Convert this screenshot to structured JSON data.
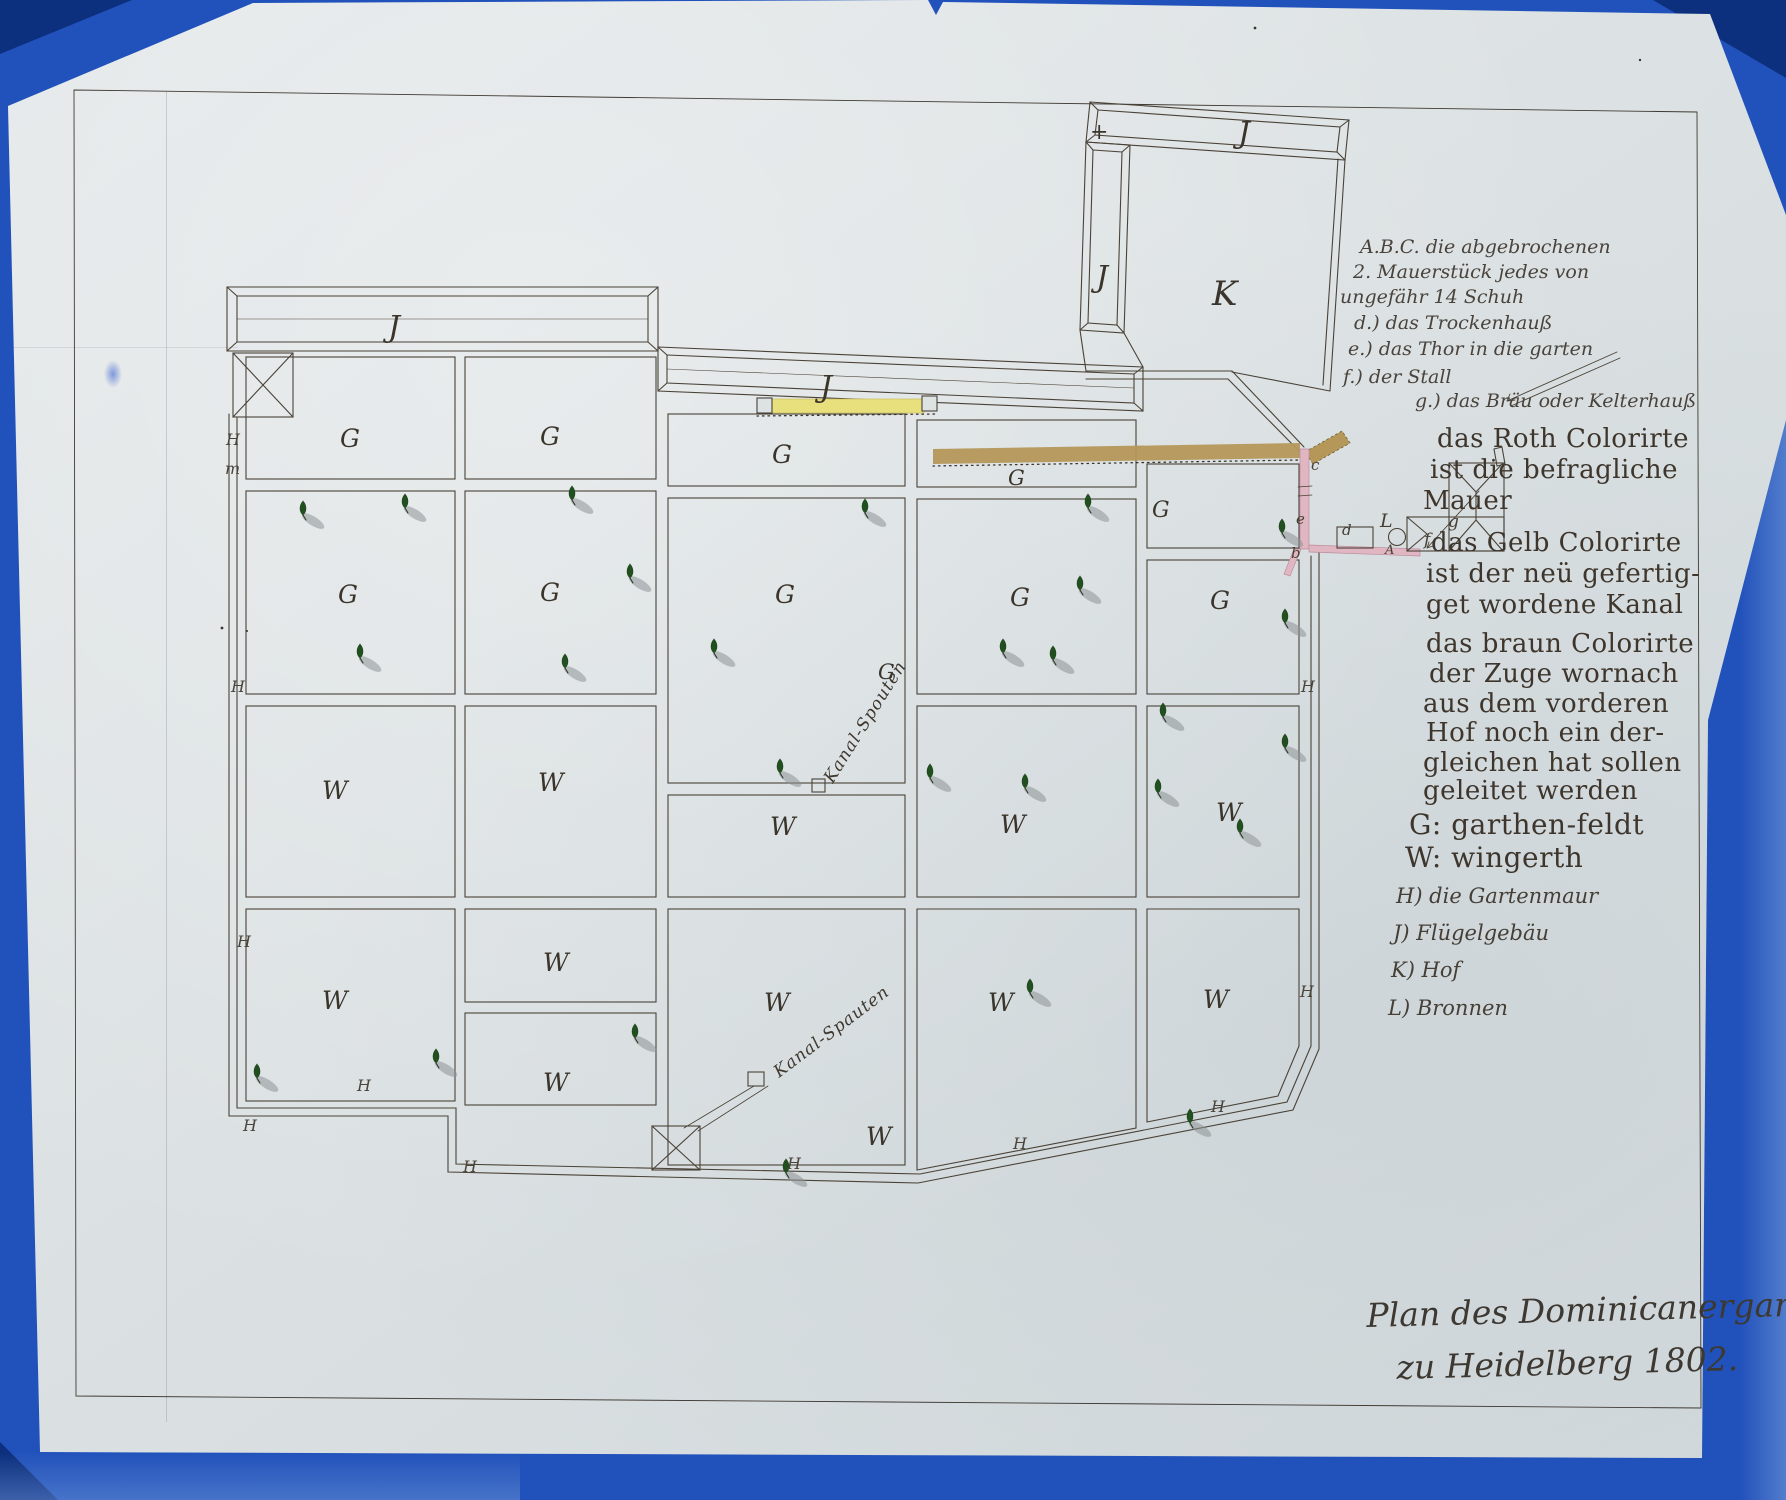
{
  "document": {
    "kind": "hand-drawn garden plan, Heidelberg 1802",
    "title_lines": [
      {
        "t": "Plan des Dominicanergartens",
        "x": 1366,
        "y": 1296,
        "r": -1.5
      },
      {
        "t": "zu Heidelberg 1802.",
        "x": 1396,
        "y": 1348,
        "r": -1.5
      }
    ]
  },
  "colors": {
    "scanner_blue": "#2152bb",
    "scanner_blue_dark": "#0c2f7e",
    "scanner_blue_light": "#6d94d6",
    "paper": "#dde2e3",
    "ink": "#4a4237",
    "ink_dark": "#332d26",
    "canal_yellow": "#e8df7d",
    "canal_brown": "#b5975a",
    "wall_pink": "#e0b6c2",
    "tree_green": "#21501f",
    "shadow_grey": "#8e9496"
  },
  "legend": {
    "script_notes": [
      {
        "t": "A.B.C. die abgebrochenen",
        "x": 1360,
        "y": 236
      },
      {
        "t": "2. Mauerstück jedes von",
        "x": 1353,
        "y": 261
      },
      {
        "t": "ungefähr 14 Schuh",
        "x": 1340,
        "y": 286
      },
      {
        "t": "d.) das Trockenhauß",
        "x": 1354,
        "y": 312
      },
      {
        "t": "e.) das Thor in die garten",
        "x": 1348,
        "y": 338
      },
      {
        "t": "f.) der Stall",
        "x": 1343,
        "y": 366
      },
      {
        "t": "g.) das Bräu oder Kelterhauß",
        "x": 1415,
        "y": 390
      }
    ],
    "gothic_lines": [
      {
        "t": "das Roth Colorirte",
        "x": 1437,
        "y": 424
      },
      {
        "t": "ist die befragliche",
        "x": 1430,
        "y": 455
      },
      {
        "t": "Mauer",
        "x": 1423,
        "y": 486
      },
      {
        "t": "das Gelb Colorirte",
        "x": 1431,
        "y": 528
      },
      {
        "t": "ist der neü gefertig-",
        "x": 1426,
        "y": 559
      },
      {
        "t": "get wordene Kanal",
        "x": 1426,
        "y": 590
      },
      {
        "t": "das braun Colorirte",
        "x": 1426,
        "y": 629
      },
      {
        "t": "der Zuge wornach",
        "x": 1429,
        "y": 659
      },
      {
        "t": "aus dem vorderen",
        "x": 1423,
        "y": 689
      },
      {
        "t": "Hof noch ein der-",
        "x": 1426,
        "y": 718
      },
      {
        "t": "gleichen hat sollen",
        "x": 1423,
        "y": 748
      },
      {
        "t": "geleitet werden",
        "x": 1423,
        "y": 776
      },
      {
        "t": "G: garthen-feldt",
        "x": 1409,
        "y": 808,
        "s": 28
      },
      {
        "t": "W: wingerth",
        "x": 1405,
        "y": 841,
        "s": 28
      }
    ],
    "key_lines": [
      {
        "t": "H) die Gartenmaur",
        "x": 1396,
        "y": 884
      },
      {
        "t": "J) Flügelgebäu",
        "x": 1393,
        "y": 921
      },
      {
        "t": "K) Hof",
        "x": 1391,
        "y": 958
      },
      {
        "t": "L) Bronnen",
        "x": 1388,
        "y": 996
      }
    ]
  },
  "plan": {
    "field_labels": [
      {
        "t": "G",
        "x": 340,
        "y": 424
      },
      {
        "t": "G",
        "x": 540,
        "y": 422
      },
      {
        "t": "G",
        "x": 772,
        "y": 440
      },
      {
        "t": "G",
        "x": 1008,
        "y": 466,
        "s": 21
      },
      {
        "t": "G",
        "x": 1152,
        "y": 498,
        "s": 22
      },
      {
        "t": "G",
        "x": 338,
        "y": 580
      },
      {
        "t": "G",
        "x": 540,
        "y": 578
      },
      {
        "t": "G",
        "x": 775,
        "y": 580
      },
      {
        "t": "G",
        "x": 878,
        "y": 660,
        "s": 21
      },
      {
        "t": "G",
        "x": 1010,
        "y": 583
      },
      {
        "t": "G",
        "x": 1210,
        "y": 586
      },
      {
        "t": "W",
        "x": 322,
        "y": 776
      },
      {
        "t": "W",
        "x": 538,
        "y": 768
      },
      {
        "t": "W",
        "x": 770,
        "y": 812
      },
      {
        "t": "W",
        "x": 1000,
        "y": 810
      },
      {
        "t": "W",
        "x": 1216,
        "y": 798
      },
      {
        "t": "W",
        "x": 322,
        "y": 986
      },
      {
        "t": "W",
        "x": 543,
        "y": 948
      },
      {
        "t": "W",
        "x": 543,
        "y": 1068
      },
      {
        "t": "W",
        "x": 764,
        "y": 988
      },
      {
        "t": "W",
        "x": 866,
        "y": 1122
      },
      {
        "t": "W",
        "x": 988,
        "y": 988
      },
      {
        "t": "W",
        "x": 1203,
        "y": 985
      }
    ],
    "building_labels": [
      {
        "t": "J",
        "x": 388,
        "y": 310,
        "s": 30
      },
      {
        "t": "J",
        "x": 820,
        "y": 370,
        "s": 30
      },
      {
        "t": "J",
        "x": 1096,
        "y": 260,
        "s": 30
      },
      {
        "t": "J",
        "x": 1238,
        "y": 116,
        "s": 30
      },
      {
        "t": "K",
        "x": 1212,
        "y": 274,
        "s": 34
      },
      {
        "t": "+",
        "x": 1090,
        "y": 120,
        "s": 22
      }
    ],
    "wall_labels": [
      {
        "t": "H",
        "x": 226,
        "y": 430
      },
      {
        "t": "m",
        "x": 225,
        "y": 459
      },
      {
        "t": "H",
        "x": 231,
        "y": 677
      },
      {
        "t": "H",
        "x": 237,
        "y": 932
      },
      {
        "t": "H",
        "x": 243,
        "y": 1116
      },
      {
        "t": "H",
        "x": 357,
        "y": 1076
      },
      {
        "t": "H",
        "x": 463,
        "y": 1157
      },
      {
        "t": "H",
        "x": 787,
        "y": 1154
      },
      {
        "t": "H",
        "x": 1013,
        "y": 1134
      },
      {
        "t": "H",
        "x": 1211,
        "y": 1097
      },
      {
        "t": "H",
        "x": 1300,
        "y": 982
      },
      {
        "t": "H",
        "x": 1301,
        "y": 677
      }
    ],
    "detail_labels": [
      {
        "t": "c",
        "x": 1311,
        "y": 456
      },
      {
        "t": "e",
        "x": 1296,
        "y": 510
      },
      {
        "t": "b",
        "x": 1291,
        "y": 544
      },
      {
        "t": "d",
        "x": 1342,
        "y": 521
      },
      {
        "t": "L",
        "x": 1380,
        "y": 510,
        "s": 19
      },
      {
        "t": "A",
        "x": 1385,
        "y": 543,
        "s": 13
      },
      {
        "t": "f",
        "x": 1424,
        "y": 530,
        "s": 17
      },
      {
        "t": "g",
        "x": 1448,
        "y": 512,
        "s": 17
      }
    ],
    "canal_labels": [
      {
        "t": "Kanal-Spouten",
        "x": 820,
        "y": 776,
        "r": -58,
        "s": 17
      },
      {
        "t": "Kanal-Spauten",
        "x": 770,
        "y": 1066,
        "r": -37,
        "s": 17
      }
    ],
    "trees": [
      [
        303,
        510
      ],
      [
        405,
        503
      ],
      [
        572,
        495
      ],
      [
        865,
        508
      ],
      [
        1088,
        503
      ],
      [
        1282,
        528
      ],
      [
        630,
        573
      ],
      [
        1080,
        585
      ],
      [
        1285,
        618
      ],
      [
        360,
        653
      ],
      [
        565,
        663
      ],
      [
        714,
        648
      ],
      [
        1003,
        648
      ],
      [
        1053,
        655
      ],
      [
        1163,
        712
      ],
      [
        1285,
        743
      ],
      [
        780,
        768
      ],
      [
        930,
        773
      ],
      [
        1025,
        783
      ],
      [
        1158,
        788
      ],
      [
        1240,
        828
      ],
      [
        436,
        1058
      ],
      [
        257,
        1073
      ],
      [
        635,
        1033
      ],
      [
        1030,
        988
      ],
      [
        1190,
        1118
      ],
      [
        786,
        1168
      ]
    ]
  }
}
